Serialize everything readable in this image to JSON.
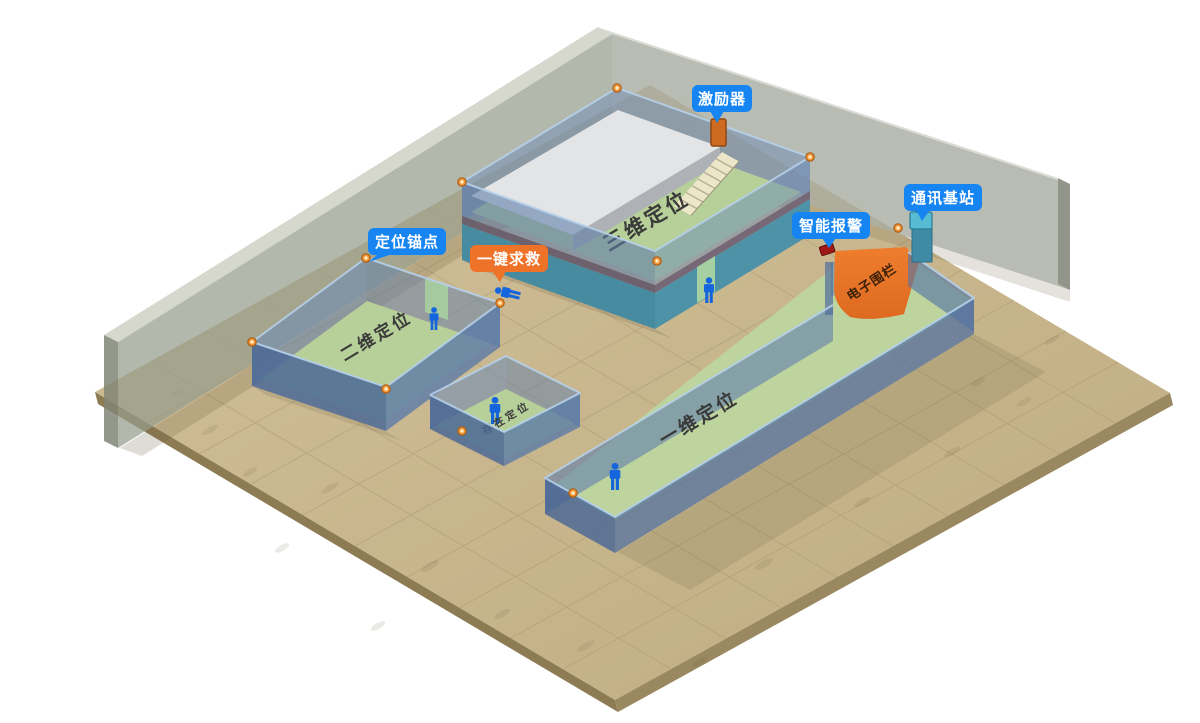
{
  "labels": {
    "exciter": "激励器",
    "comm_base_station": "通讯基站",
    "smart_alarm": "智能报警",
    "positioning_anchor": "定位锚点",
    "one_key_sos": "一键求救"
  },
  "zones": {
    "zone_3d": "三维定位",
    "zone_2d": "二维定位",
    "zone_presence": "存在定位",
    "zone_1d": "一维定位",
    "electronic_fence": "电子围栏"
  },
  "colors": {
    "bubble_blue": "#1685F2",
    "bubble_orange": "#EE7227",
    "fence_orange": "#E8742B",
    "floor_tan": "#C9B68C",
    "room_green": "#B7D099",
    "wall_blue": "#6E93BE",
    "wall_teal": "#4E92A7",
    "person_blue": "#1565DC",
    "anchor_orange": "#F2953B"
  }
}
